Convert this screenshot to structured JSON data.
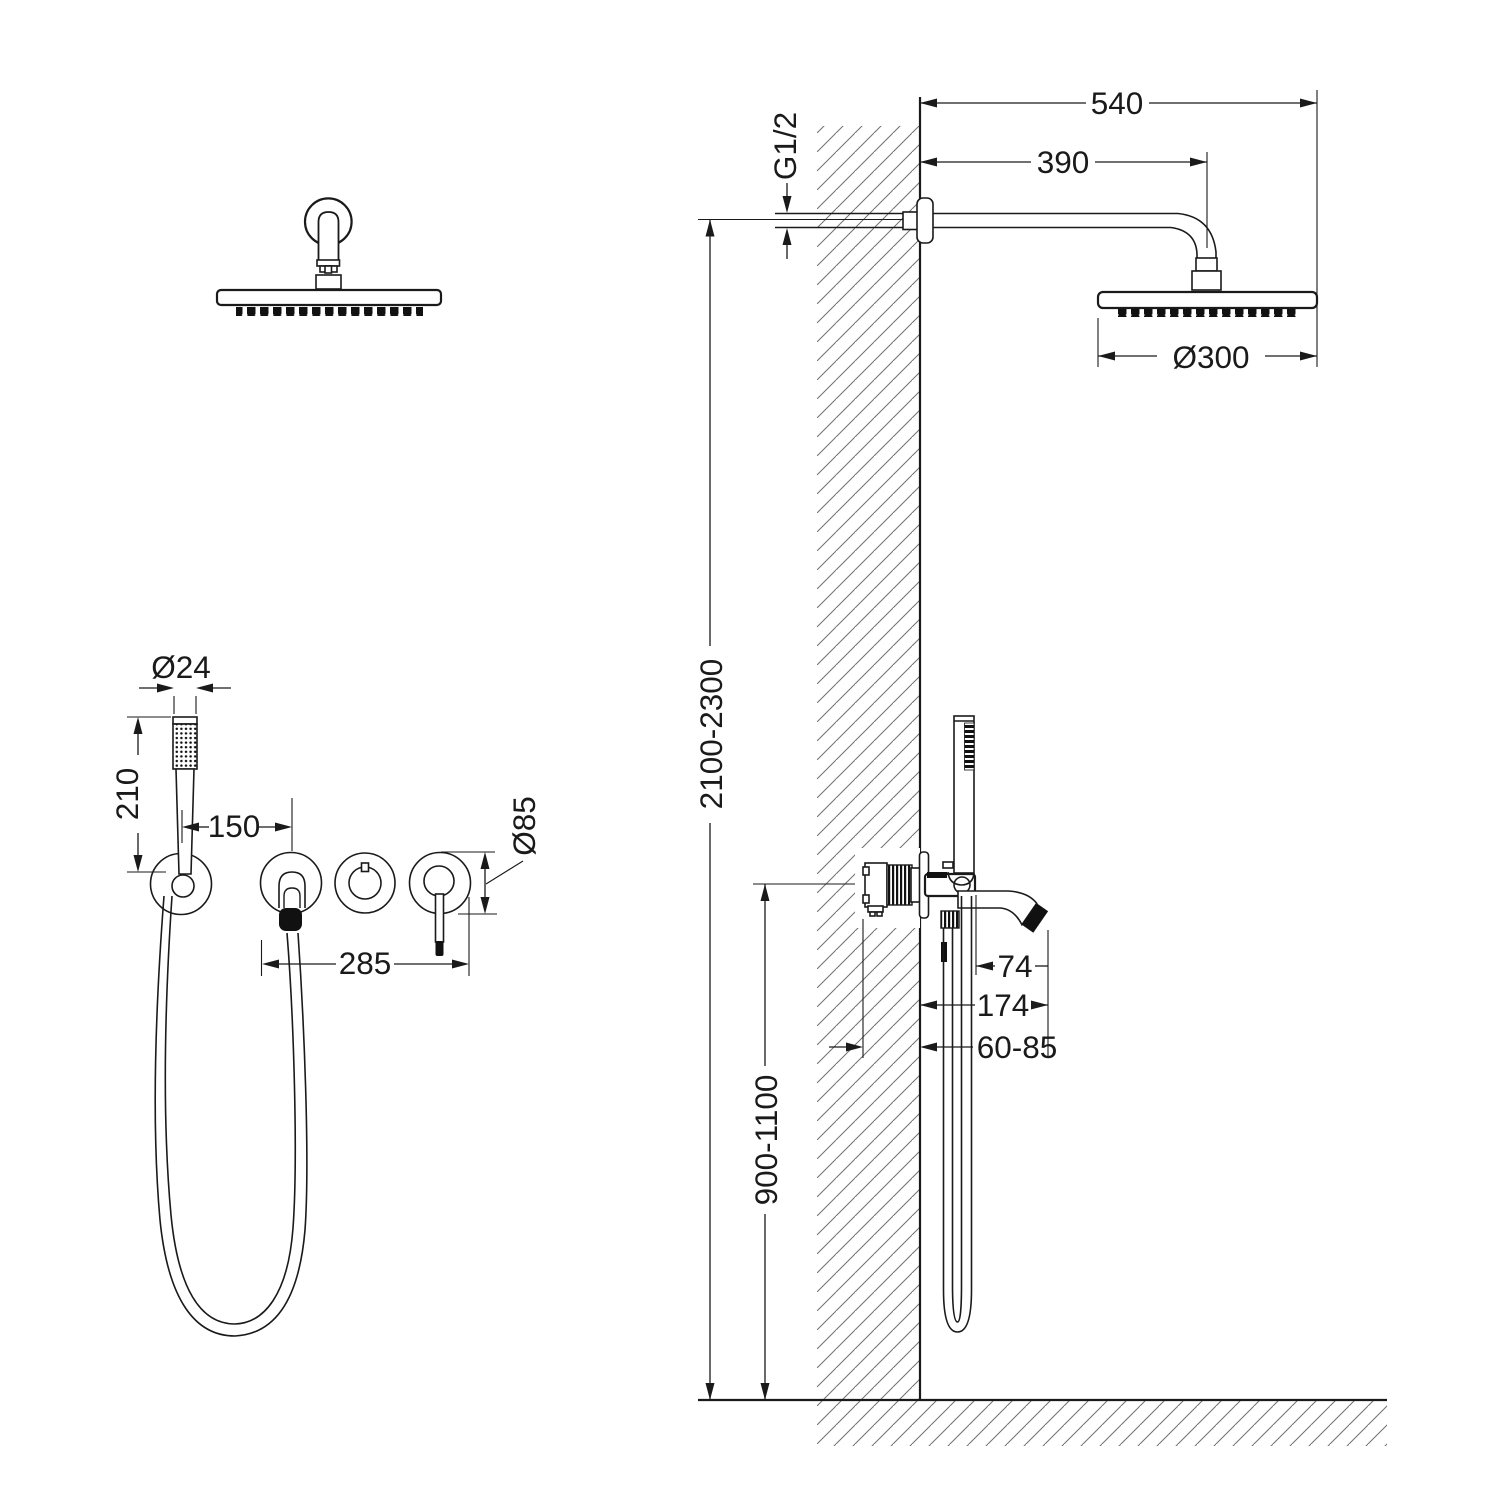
{
  "drawing": {
    "dims": {
      "arm_total": "540",
      "arm_projection": "390",
      "thread_size": "G1/2",
      "rain_head_diameter": "Ø300",
      "install_height_range": "2100-2300",
      "hand_shower_diameter": "Ø24",
      "hand_shower_length": "210",
      "holder_to_spout": "150",
      "escutcheon_diameter": "Ø85",
      "trim_span": "285",
      "spout_reach": "74",
      "spout_total_reach": "174",
      "wall_embed_depth": "60-85",
      "mixer_height_range": "900-1100"
    },
    "colors": {
      "line": "#1a1a1a",
      "hatch": "#707070",
      "background": "#ffffff"
    }
  }
}
